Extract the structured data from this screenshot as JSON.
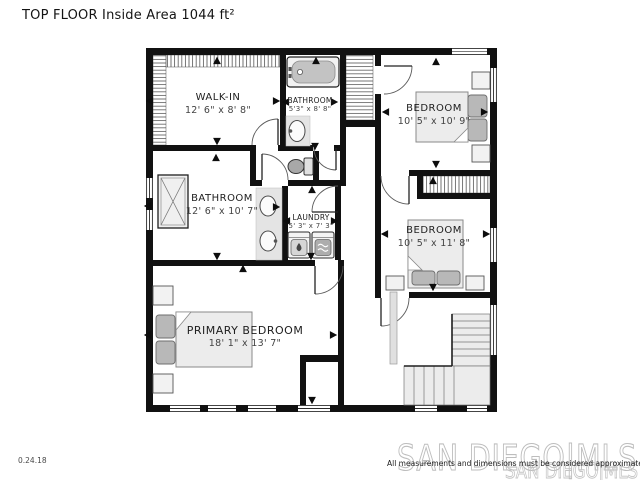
{
  "title": "TOP FLOOR Inside Area 1044 ft²",
  "footer": {
    "date": "0.24.18",
    "disclaimer": "All measurements and dimensions must be considered approximate"
  },
  "watermark": {
    "primary": "SAN DIEGO|MLS",
    "secondary": "SAN DIEGO|MLS"
  },
  "rooms": {
    "walk_in": {
      "name": "WALK-IN",
      "dims": "12' 6\" x 8' 8\""
    },
    "bathroom_top": {
      "name": "BATHROOM",
      "dims": "5'3\" x 8' 8\""
    },
    "bedroom_top_right": {
      "name": "BEDROOM",
      "dims": "10' 5\" x 10' 9\""
    },
    "bathroom_left": {
      "name": "BATHROOM",
      "dims": "12' 6\" x 10' 7\""
    },
    "laundry": {
      "name": "LAUNDRY",
      "dims": "5' 3\" x 7' 3\""
    },
    "bedroom_right": {
      "name": "BEDROOM",
      "dims": "10' 5\" x 11' 8\""
    },
    "primary_bedroom": {
      "name": "PRIMARY BEDROOM",
      "dims": "18' 1\" x 13' 7\""
    }
  },
  "colors": {
    "wall": "#111111",
    "furniture_fill": "#ededed",
    "furniture_dark": "#b8b8b8",
    "watermark": "#bdbdbd"
  }
}
